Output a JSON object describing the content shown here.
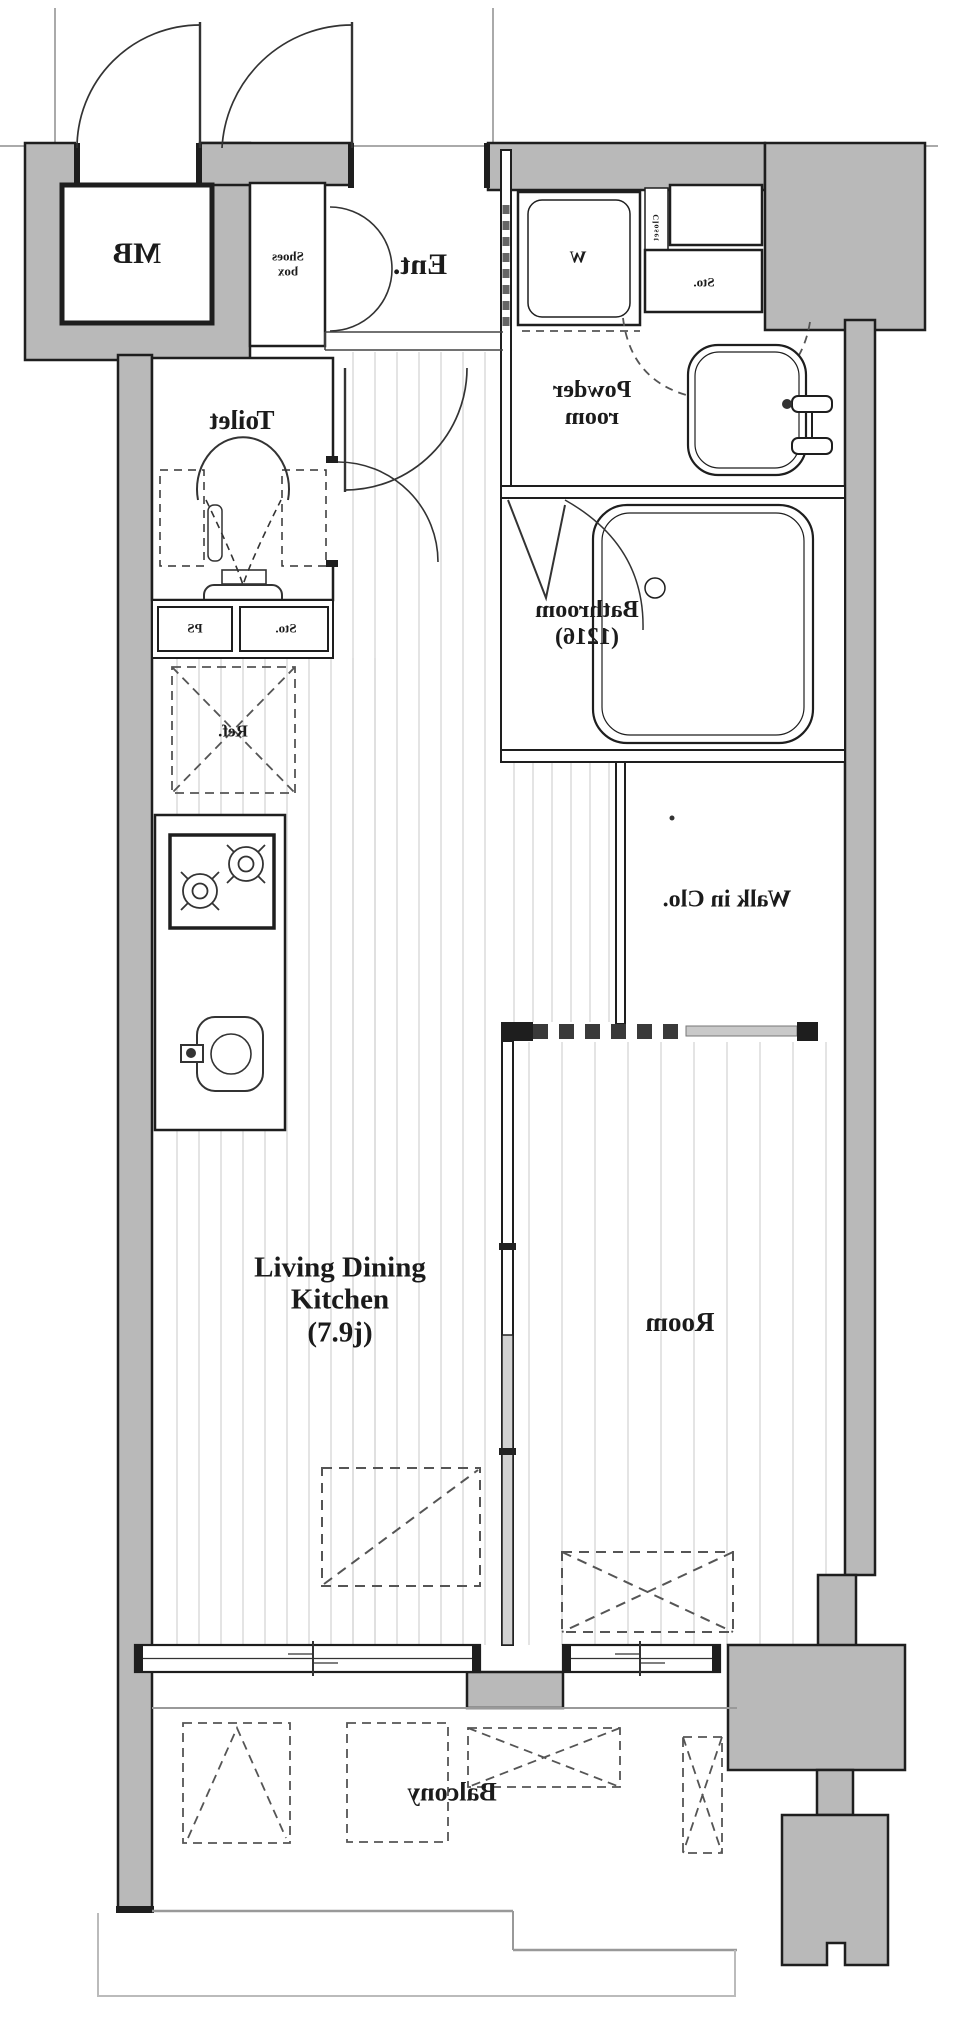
{
  "title": "Apartment floor plan (mirrored print)",
  "colors": {
    "wall_fill": "#b9b9b9",
    "wall_line": "#1e1e1e",
    "floor_line": "#d6d6d6",
    "dashed_line": "#555555"
  },
  "rooms": {
    "mb": {
      "label": "MB",
      "mirrored": true
    },
    "shoes_box": {
      "line1": "Shoes",
      "line2": "box",
      "mirrored": true
    },
    "entrance": {
      "label": "Ent.",
      "mirrored": true
    },
    "washer": {
      "label": "W",
      "mirrored": true
    },
    "closet": {
      "label": "Closet",
      "mirrored": true
    },
    "storage_top": {
      "label": "Sto.",
      "mirrored": true
    },
    "powder_room": {
      "line1": "Powder",
      "line2": "room",
      "mirrored": true
    },
    "bathroom": {
      "line1": "Bathroom",
      "line2": "(1216)",
      "mirrored": true
    },
    "toilet": {
      "label": "Toilet",
      "mirrored": true
    },
    "ps": {
      "label": "PS",
      "mirrored": true
    },
    "storage_mid": {
      "label": "Sto.",
      "mirrored": true
    },
    "refrigerator": {
      "label": "Ref.",
      "mirrored": true
    },
    "walk_in_closet": {
      "label": "Walk in Clo.",
      "mirrored": true
    },
    "ldk": {
      "line1": "Living Dining",
      "line2": "Kitchen",
      "line3": "(7.9j)",
      "mirrored": false
    },
    "room": {
      "label": "Room",
      "mirrored": true
    },
    "balcony": {
      "label": "Balcony",
      "mirrored": true
    }
  }
}
